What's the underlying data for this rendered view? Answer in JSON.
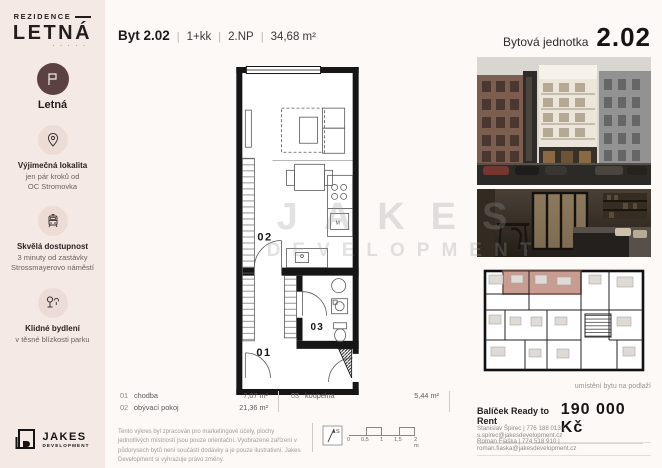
{
  "colors": {
    "sidebar_bg": "#f5e9e5",
    "page_bg": "#fcf9f6",
    "brand_brown": "#5b4240",
    "plan_wall": "#161616",
    "highlight_unit": "#c89c90"
  },
  "sidebar": {
    "logo_line1": "REZIDENCE",
    "logo_line2": "LETNÁ",
    "logo_dots": "· · · · ·",
    "badge_label": "Letná",
    "features": [
      {
        "icon": "location-pin-icon",
        "title": "Výjimečná lokalita",
        "line1": "jen pár kroků od",
        "line2": "OC Stromovka"
      },
      {
        "icon": "tram-icon",
        "title": "Skvělá dostupnost",
        "line1": "3 minuty od zastávky",
        "line2": "Strossmayerovo náměstí"
      },
      {
        "icon": "park-icon",
        "title": "Klidné bydlení",
        "line1": "v těsné blízkosti parku",
        "line2": ""
      }
    ],
    "developer": {
      "name": "JAKES",
      "sub": "DEVELOPMENT"
    }
  },
  "header": {
    "unit": "Byt 2.02",
    "sep": "|",
    "layout": "1+kk",
    "floor": "2.NP",
    "area": "34,68 m²"
  },
  "plan": {
    "room_labels": {
      "r01": "01",
      "r02": "02",
      "r03": "03",
      "appliance": "M"
    },
    "legend": [
      {
        "num": "01",
        "name": "chodba",
        "area": "7,07 m²"
      },
      {
        "num": "02",
        "name": "obývací pokoj",
        "area": "21,36 m²"
      },
      {
        "num": "03",
        "name": "koupelna",
        "area": "5,44 m²"
      }
    ],
    "disclaimer": "Tento výkres byl zpracován pro marketingové účely, plochy jednotlivých místností jsou pouze orientační. Vyobrazené zařízení v půdorysech bytů není součástí dodávky a je pouze ilustrativní. Jakes Development si vyhrazuje právo změny.",
    "compass_label": "S",
    "scale_ticks": [
      "0",
      "0,5",
      "1",
      "1,5",
      "2 m"
    ]
  },
  "right_panel": {
    "title_label": "Bytová jednotka",
    "title_number": "2.02",
    "floor_caption": "umístění bytu na podlaží",
    "price_label": "Balíček Ready to Rent",
    "price_value": "190 000 Kč",
    "contacts": [
      {
        "line": "Stanislav Špirec  |  776 188 013  |  s.spirec@jakesdevelopment.cz"
      },
      {
        "line": "Roman Fiaška  |  774 518 910  |  roman.fiaska@jakesdevelopment.cz"
      }
    ]
  },
  "watermark": {
    "line1": "JAKES",
    "line2": "DEVELOPMENT"
  }
}
